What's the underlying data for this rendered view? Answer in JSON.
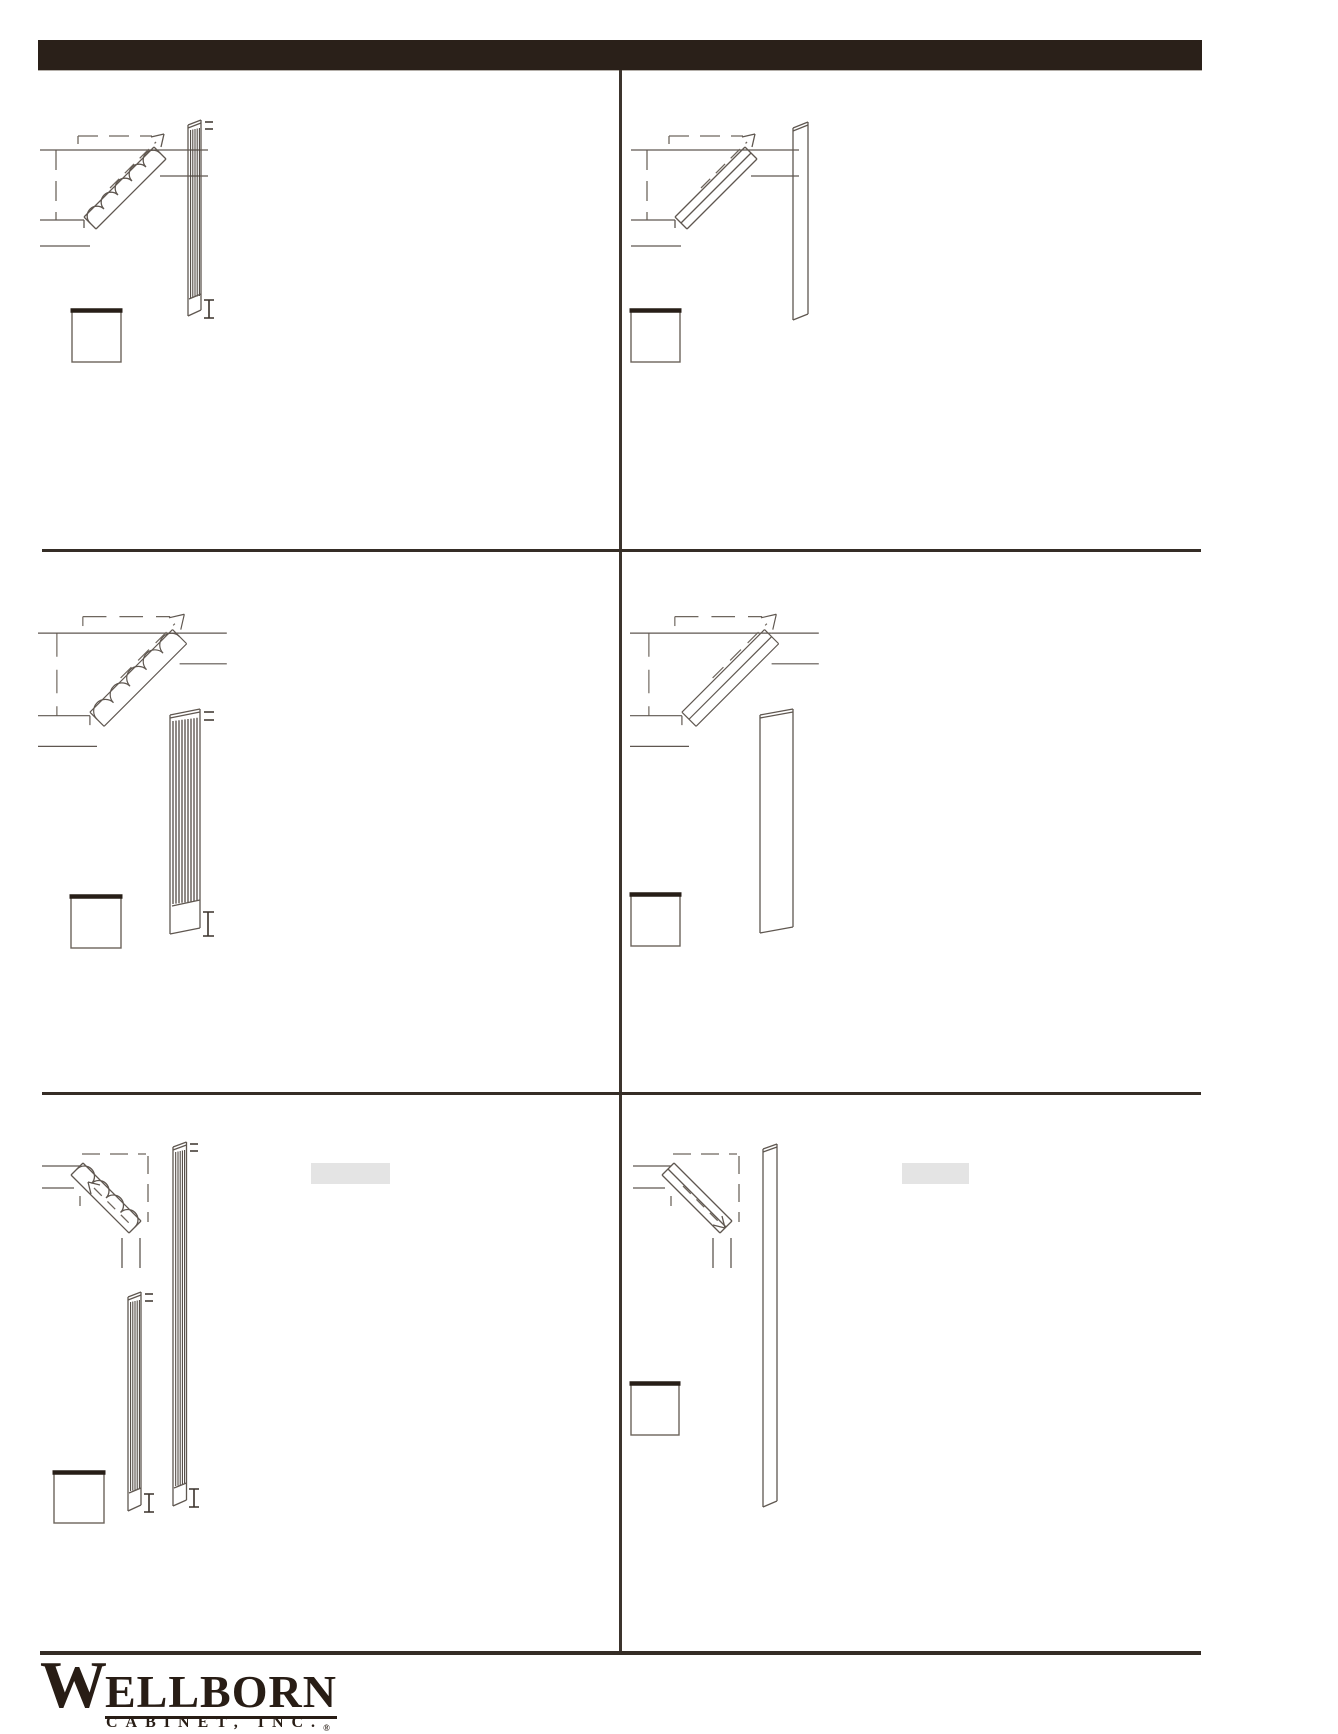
{
  "page": {
    "width": 1338,
    "height": 1731,
    "background": "#ffffff"
  },
  "header": {
    "title": "",
    "bar_color": "#2a2019"
  },
  "grid": {
    "divider_color": "#352d26",
    "line_color": "#5f5750",
    "flute_color": "#453d36",
    "highlight_color": "#e4e4e4",
    "cells": [
      {
        "position": "row1-left",
        "diagrams": [
          "corner-cabinet-with-fluted-angle-filler-isometric",
          "fluted-filler-front-view-with-dimension-marks"
        ],
        "swatch_box": true,
        "highlight": false
      },
      {
        "position": "row1-right",
        "diagrams": [
          "corner-cabinet-with-plain-angle-filler-isometric",
          "plain-filler-front-view"
        ],
        "swatch_box": true,
        "highlight": false
      },
      {
        "position": "row2-left",
        "diagrams": [
          "corner-cabinet-with-fluted-angle-filler-isometric-large",
          "wide-fluted-filler-front-view-with-dimension-marks"
        ],
        "swatch_box": true,
        "highlight": false
      },
      {
        "position": "row2-right",
        "diagrams": [
          "corner-cabinet-with-plain-angle-filler-isometric-large",
          "wide-plain-filler-front-view"
        ],
        "swatch_box": true,
        "highlight": false
      },
      {
        "position": "row3-left",
        "diagrams": [
          "corner-fluted-angle-filler-isometric-mirrored",
          "tall-fluted-filler-front-view-with-dimension-marks",
          "narrow-fluted-filler-front-view-with-dimension-marks"
        ],
        "swatch_box": true,
        "highlight": true
      },
      {
        "position": "row3-right",
        "diagrams": [
          "corner-plain-angle-filler-isometric-mirrored",
          "tall-plain-filler-front-view"
        ],
        "swatch_box": true,
        "highlight": true
      }
    ]
  },
  "footer": {
    "rule_color": "#352d26",
    "logo": {
      "initial": "W",
      "rest": "ELLBORN",
      "subtitle": "CABINET, INC.",
      "registered": "®"
    }
  }
}
